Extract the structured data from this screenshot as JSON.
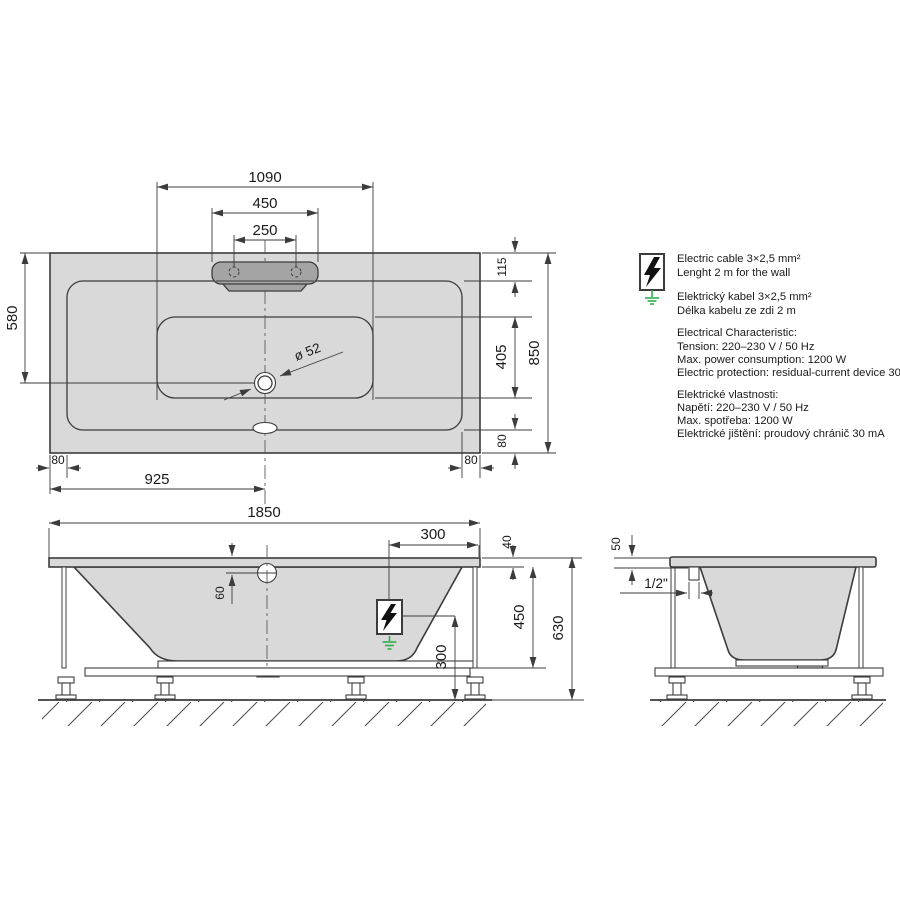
{
  "colors": {
    "line": "#3c3c3c",
    "tub": "#d9d9d9",
    "headrest": "#a4a4a4",
    "green": "#2fae4c"
  },
  "dims": {
    "top": {
      "floor_length": "1090",
      "headrest_width": "450",
      "holes_spacing": "250",
      "drain_from_edge": "580",
      "rim_head": "115",
      "floor_width": "405",
      "rim_side": "80",
      "width_total": "850",
      "half_length": "925",
      "drain_dia": "ø 52"
    },
    "front": {
      "length_total": "1850",
      "cable_offset": "300",
      "rim_thickness": "40",
      "overflow_offset": "60",
      "skirt_height": "450",
      "height_total": "630",
      "cable_height": "300"
    },
    "side": {
      "rim_drop": "50",
      "pipe_size": "1/2\""
    }
  },
  "panel": {
    "cable_en_1": "Electric cable 3×2,5 mm²",
    "cable_en_2": "Lenght 2 m for the wall",
    "cable_cs_1": "Elektrický kabel 3×2,5 mm²",
    "cable_cs_2": "Délka kabelu ze zdi 2 m",
    "elec_en_title": "Electrical Characteristic:",
    "elec_en_1": "Tension: 220–230 V / 50 Hz",
    "elec_en_2": "Max. power consumption: 1200 W",
    "elec_en_3": "Electric protection: residual-current device 30 mA",
    "elec_cs_title": "Elektrické vlastnosti:",
    "elec_cs_1": "Napětí: 220–230 V / 50 Hz",
    "elec_cs_2": "Max. spotřeba: 1200 W",
    "elec_cs_3": "Elektrické jištění: proudový chránič 30 mA"
  }
}
